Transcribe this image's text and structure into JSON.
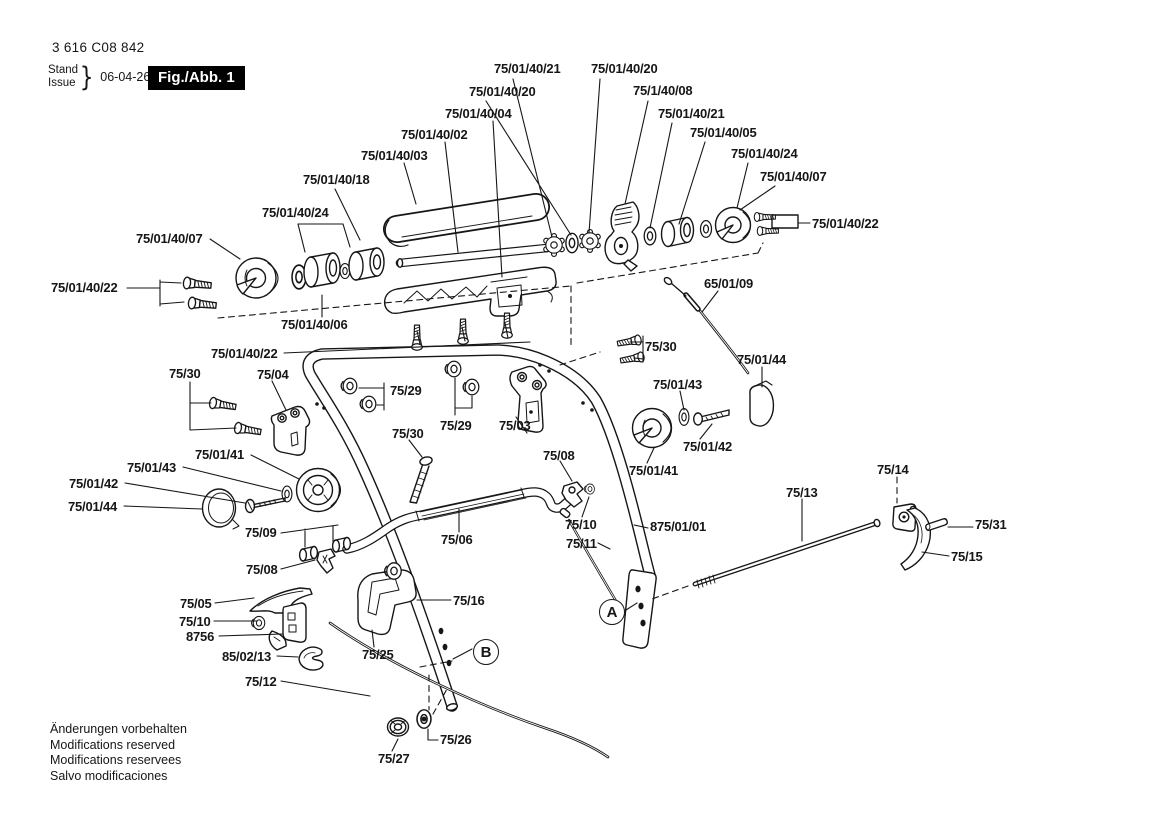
{
  "header": {
    "part_number": "3 616 C08 842",
    "stand": "Stand",
    "issue": "Issue",
    "brace": "}",
    "date": "06-04-26",
    "figure": "Fig./Abb. 1"
  },
  "colors": {
    "ink": "#161616",
    "badge_bg": "#000000",
    "badge_fg": "#ffffff",
    "background": "#ffffff"
  },
  "footer": {
    "lines": [
      "Änderungen vorbehalten",
      "Modifications reserved",
      "Modifications reservees",
      "Salvo modificaciones"
    ]
  },
  "diagram": {
    "ref_markers": [
      {
        "letter": "A",
        "x": 612,
        "y": 612
      },
      {
        "letter": "B",
        "x": 486,
        "y": 652
      }
    ],
    "labels": [
      {
        "text": "75/01/40/21",
        "x": 494,
        "y": 62
      },
      {
        "text": "75/01/40/20",
        "x": 591,
        "y": 62
      },
      {
        "text": "75/01/40/20",
        "x": 469,
        "y": 85
      },
      {
        "text": "75/1/40/08",
        "x": 633,
        "y": 84
      },
      {
        "text": "75/01/40/04",
        "x": 445,
        "y": 107
      },
      {
        "text": "75/01/40/21",
        "x": 658,
        "y": 107
      },
      {
        "text": "75/01/40/02",
        "x": 401,
        "y": 128
      },
      {
        "text": "75/01/40/05",
        "x": 690,
        "y": 126
      },
      {
        "text": "75/01/40/03",
        "x": 361,
        "y": 149
      },
      {
        "text": "75/01/40/24",
        "x": 731,
        "y": 147
      },
      {
        "text": "75/01/40/18",
        "x": 303,
        "y": 173
      },
      {
        "text": "75/01/40/07",
        "x": 760,
        "y": 170
      },
      {
        "text": "75/01/40/24",
        "x": 262,
        "y": 206
      },
      {
        "text": "75/01/40/22",
        "x": 812,
        "y": 217
      },
      {
        "text": "75/01/40/07",
        "x": 136,
        "y": 232
      },
      {
        "text": "65/01/09",
        "x": 704,
        "y": 277
      },
      {
        "text": "75/01/40/22",
        "x": 51,
        "y": 281
      },
      {
        "text": "75/01/40/06",
        "x": 281,
        "y": 318
      },
      {
        "text": "75/01/40/22",
        "x": 211,
        "y": 347
      },
      {
        "text": "75/30",
        "x": 645,
        "y": 340
      },
      {
        "text": "75/01/44",
        "x": 737,
        "y": 353
      },
      {
        "text": "75/30",
        "x": 169,
        "y": 367
      },
      {
        "text": "75/04",
        "x": 257,
        "y": 368
      },
      {
        "text": "75/29",
        "x": 390,
        "y": 384
      },
      {
        "text": "75/01/43",
        "x": 653,
        "y": 378
      },
      {
        "text": "75/29",
        "x": 440,
        "y": 419
      },
      {
        "text": "75/03",
        "x": 499,
        "y": 419
      },
      {
        "text": "75/30",
        "x": 392,
        "y": 427
      },
      {
        "text": "75/08",
        "x": 543,
        "y": 449
      },
      {
        "text": "75/01/41",
        "x": 195,
        "y": 448
      },
      {
        "text": "75/01/43",
        "x": 127,
        "y": 461
      },
      {
        "text": "75/01/42",
        "x": 69,
        "y": 477
      },
      {
        "text": "75/01/42",
        "x": 683,
        "y": 440
      },
      {
        "text": "75/01/41",
        "x": 629,
        "y": 464
      },
      {
        "text": "75/01/44",
        "x": 68,
        "y": 500
      },
      {
        "text": "75/14",
        "x": 877,
        "y": 463
      },
      {
        "text": "75/13",
        "x": 786,
        "y": 486
      },
      {
        "text": "75/09",
        "x": 245,
        "y": 526
      },
      {
        "text": "75/10",
        "x": 565,
        "y": 518
      },
      {
        "text": "875/01/01",
        "x": 650,
        "y": 520
      },
      {
        "text": "75/31",
        "x": 975,
        "y": 518
      },
      {
        "text": "75/06",
        "x": 441,
        "y": 533
      },
      {
        "text": "75/11",
        "x": 566,
        "y": 537
      },
      {
        "text": "75/15",
        "x": 951,
        "y": 550
      },
      {
        "text": "75/08",
        "x": 246,
        "y": 563
      },
      {
        "text": "75/16",
        "x": 453,
        "y": 594
      },
      {
        "text": "75/05",
        "x": 180,
        "y": 597
      },
      {
        "text": "75/10",
        "x": 179,
        "y": 615
      },
      {
        "text": "8756",
        "x": 186,
        "y": 630
      },
      {
        "text": "85/02/13",
        "x": 222,
        "y": 650
      },
      {
        "text": "75/25",
        "x": 362,
        "y": 648
      },
      {
        "text": "75/12",
        "x": 245,
        "y": 675
      },
      {
        "text": "75/26",
        "x": 440,
        "y": 733
      },
      {
        "text": "75/27",
        "x": 378,
        "y": 752
      }
    ]
  }
}
